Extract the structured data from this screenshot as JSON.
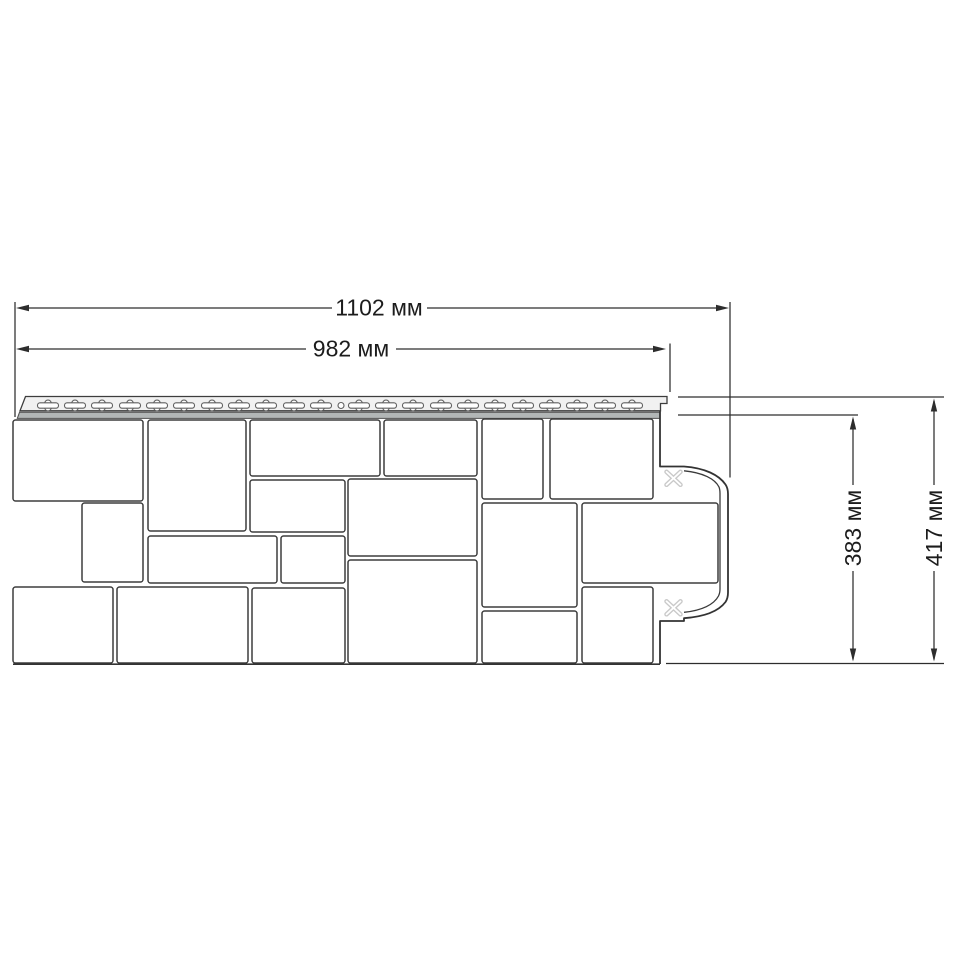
{
  "drawing": {
    "background": "#ffffff",
    "line_color": "#2d2d2d",
    "units": "мм",
    "labels": {
      "total_width": "1102 мм",
      "face_width": "982 мм",
      "face_height": "383 мм",
      "total_height": "417 мм"
    },
    "values": {
      "total_width_mm": 1102,
      "face_width_mm": 982,
      "face_height_mm": 383,
      "total_height_mm": 417
    }
  },
  "panel": {
    "stone_fill": "#ffffff",
    "stone_outline": "#3d3d3d",
    "stones": [
      [
        13,
        420,
        130,
        81
      ],
      [
        148,
        420,
        98,
        111
      ],
      [
        250,
        420,
        130,
        56
      ],
      [
        384,
        420,
        93,
        56
      ],
      [
        482,
        419,
        61,
        80
      ],
      [
        550,
        419,
        103,
        80
      ],
      [
        250,
        480,
        95,
        52
      ],
      [
        348,
        479,
        129,
        77
      ],
      [
        482,
        503,
        95,
        104
      ],
      [
        582,
        503,
        136,
        80
      ],
      [
        82,
        503,
        61,
        79
      ],
      [
        148,
        536,
        129,
        47
      ],
      [
        281,
        536,
        64,
        47
      ],
      [
        13,
        587,
        100,
        76
      ],
      [
        117,
        587,
        131,
        76
      ],
      [
        252,
        588,
        93,
        75
      ],
      [
        348,
        560,
        129,
        103
      ],
      [
        482,
        611,
        95,
        52
      ],
      [
        582,
        587,
        71,
        76
      ]
    ],
    "nail_strip": {
      "slot_centers_x": [
        48,
        75,
        102,
        130,
        157,
        184,
        212,
        239,
        266,
        294,
        321,
        359,
        386,
        413,
        441,
        468,
        495,
        523,
        550,
        577,
        605,
        632
      ],
      "slot_cy": 405.5,
      "round_hole_cx": 341,
      "round_hole_cy": 405.5,
      "hole_outline": "#606060"
    },
    "cut_marks": [
      {
        "cx": 673.5,
        "cy": 478.3
      },
      {
        "cx": 673.5,
        "cy": 607.8
      }
    ],
    "cut_mark_color": "#c9c9c9"
  }
}
